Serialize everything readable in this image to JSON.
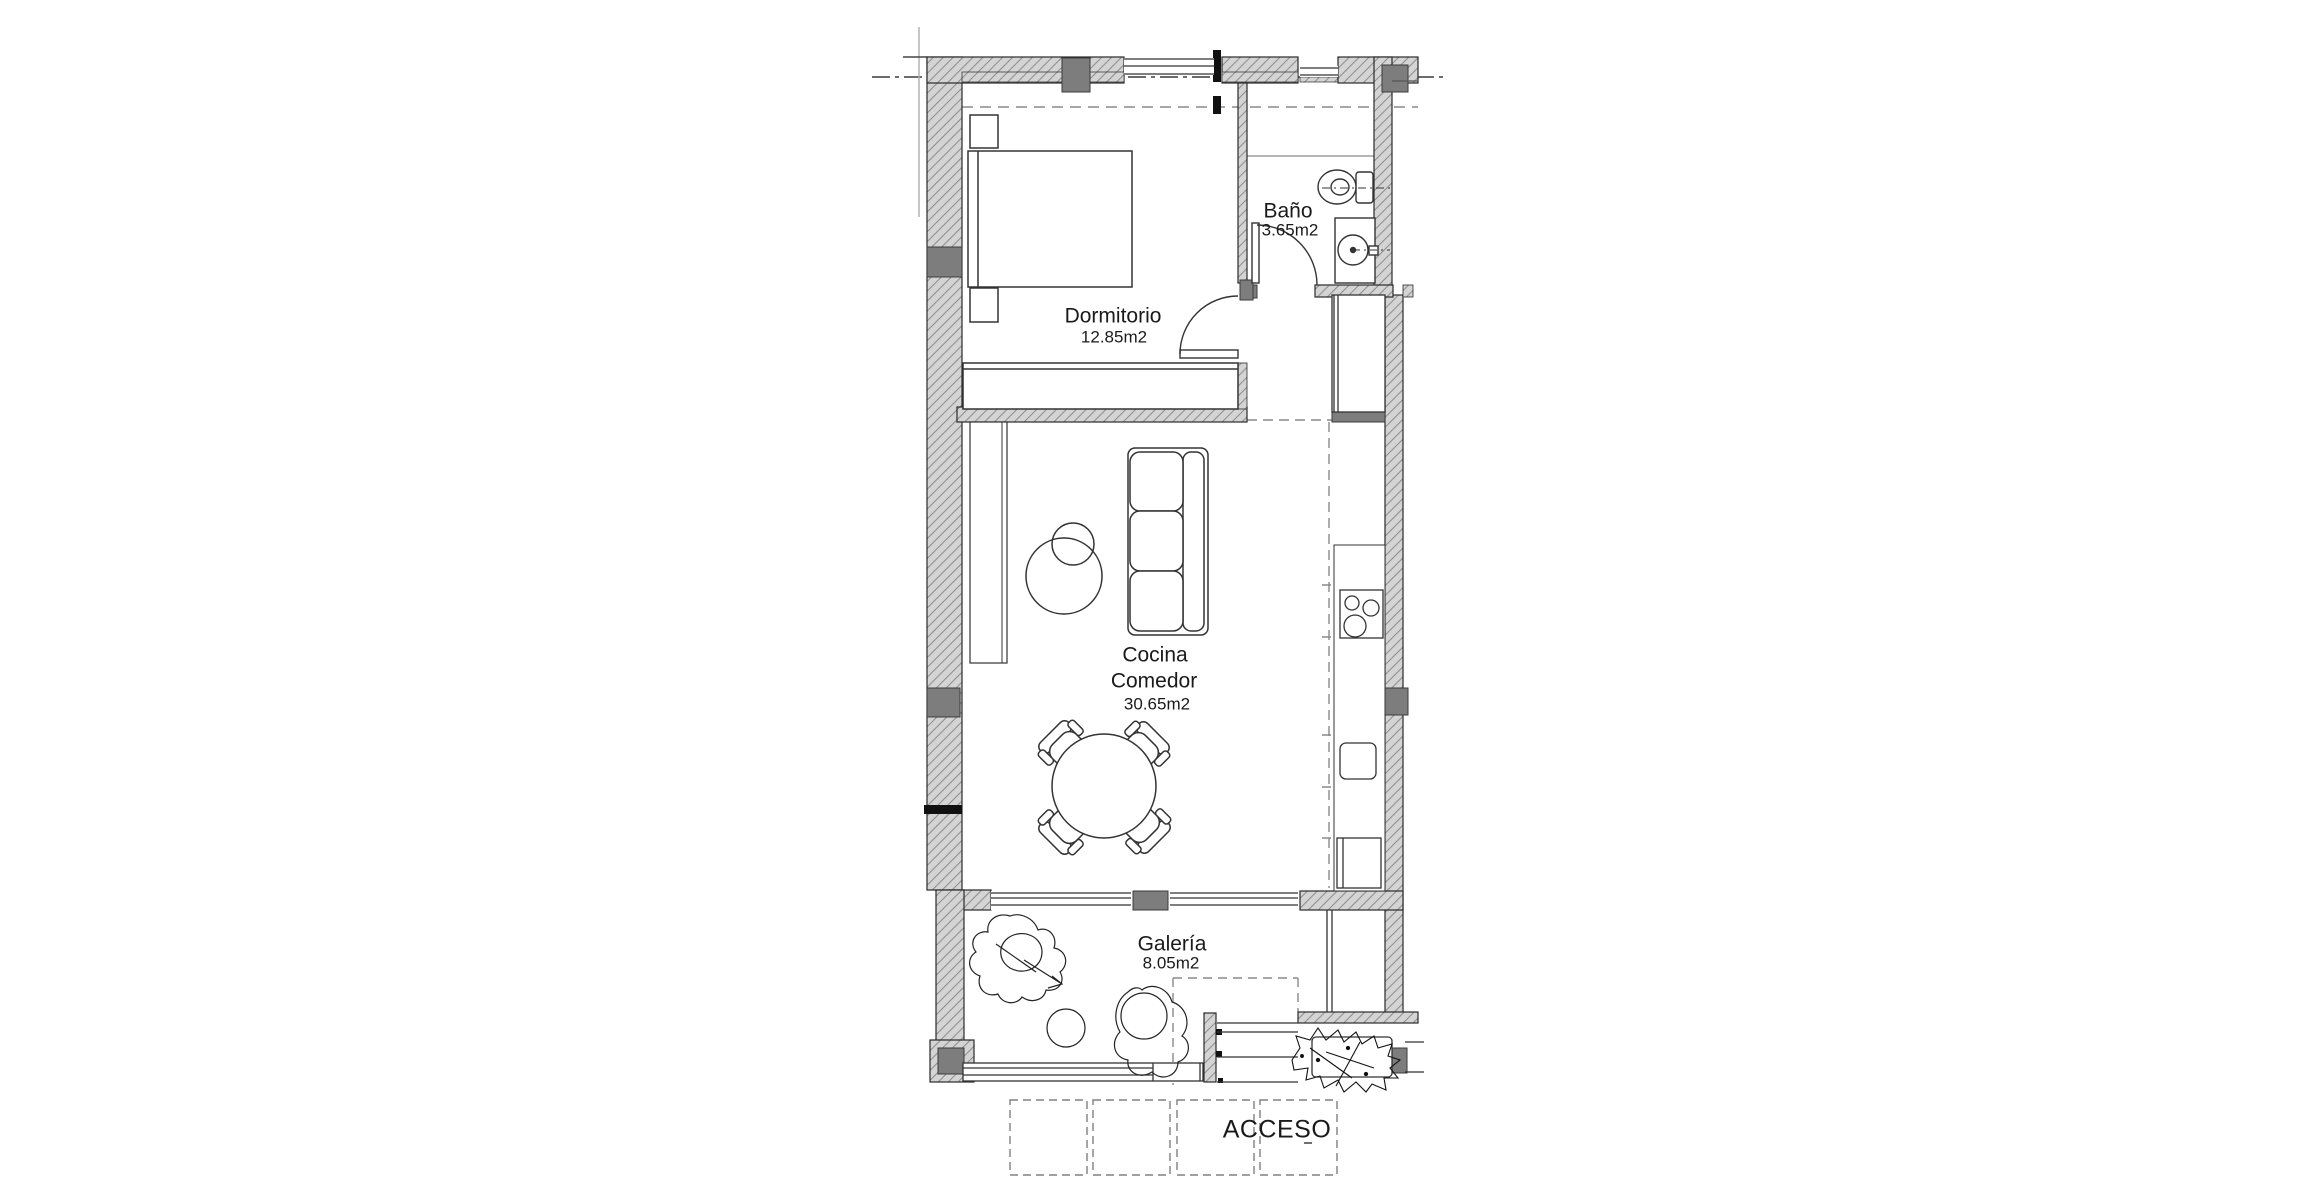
{
  "plan": {
    "rooms": {
      "dormitorio": {
        "label": "Dormitorio",
        "area": "12.85m2"
      },
      "bano": {
        "label": "Baño",
        "area": "3.65m2"
      },
      "cocina_comedor": {
        "line1": "Cocina",
        "line2": "Comedor",
        "area": "30.65m2"
      },
      "galeria": {
        "label": "Galería",
        "area": "8.05m2"
      }
    },
    "entrance_label": "ACCESO",
    "fixtures": [
      "bed-icon",
      "nightstand-icon",
      "wardrobe-icon",
      "toilet-icon",
      "washbasin-icon",
      "shower-line-icon",
      "sofa-icon",
      "coffee-table-icon",
      "dining-table-icon",
      "dining-chair-icon",
      "hob-icon",
      "kitchen-sink-icon",
      "appliance-icon",
      "plant-icon",
      "lounge-chair-icon",
      "steps-icon",
      "planter-icon",
      "paving-grid-icon"
    ],
    "colors": {
      "background": "#ffffff",
      "wall_fill": "#d4d4d4",
      "wall_hatch": "#8e8e8e",
      "column": "#7d7d7d",
      "line": "#2a2a2a",
      "light_line": "#b5b5b5",
      "dashed_line": "#8a8a8a",
      "text": "#1a1a1a"
    }
  }
}
